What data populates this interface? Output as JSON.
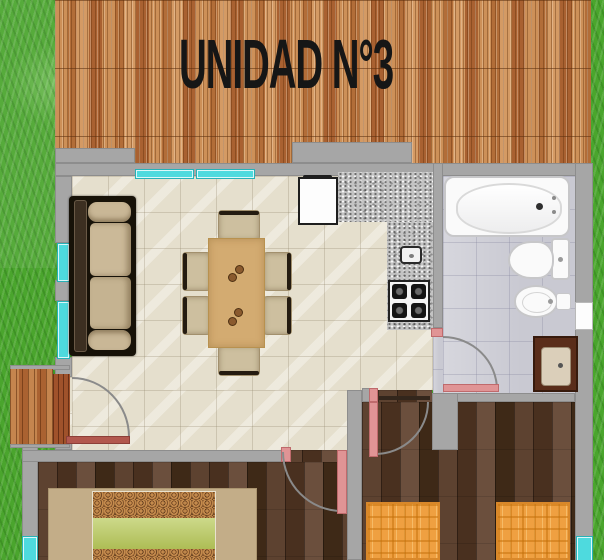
{
  "title": "UNIDAD N°3",
  "colors": {
    "grass": "#4aa52d",
    "roof_wood": "#c08048",
    "wall_gray": "#a6a6a6",
    "window_cyan": "#4edade",
    "door_pink": "#e09495",
    "entry_door_red": "#b2584e",
    "living_tile": "#e5dfcd",
    "bath_tile": "#c9c9d2",
    "bedroom_wood": "#523827",
    "counter_granite": "#c3c3c3",
    "table_wood": "#d3ab71",
    "bed_green": "#b6c666",
    "bed_orange": "#efa041"
  }
}
